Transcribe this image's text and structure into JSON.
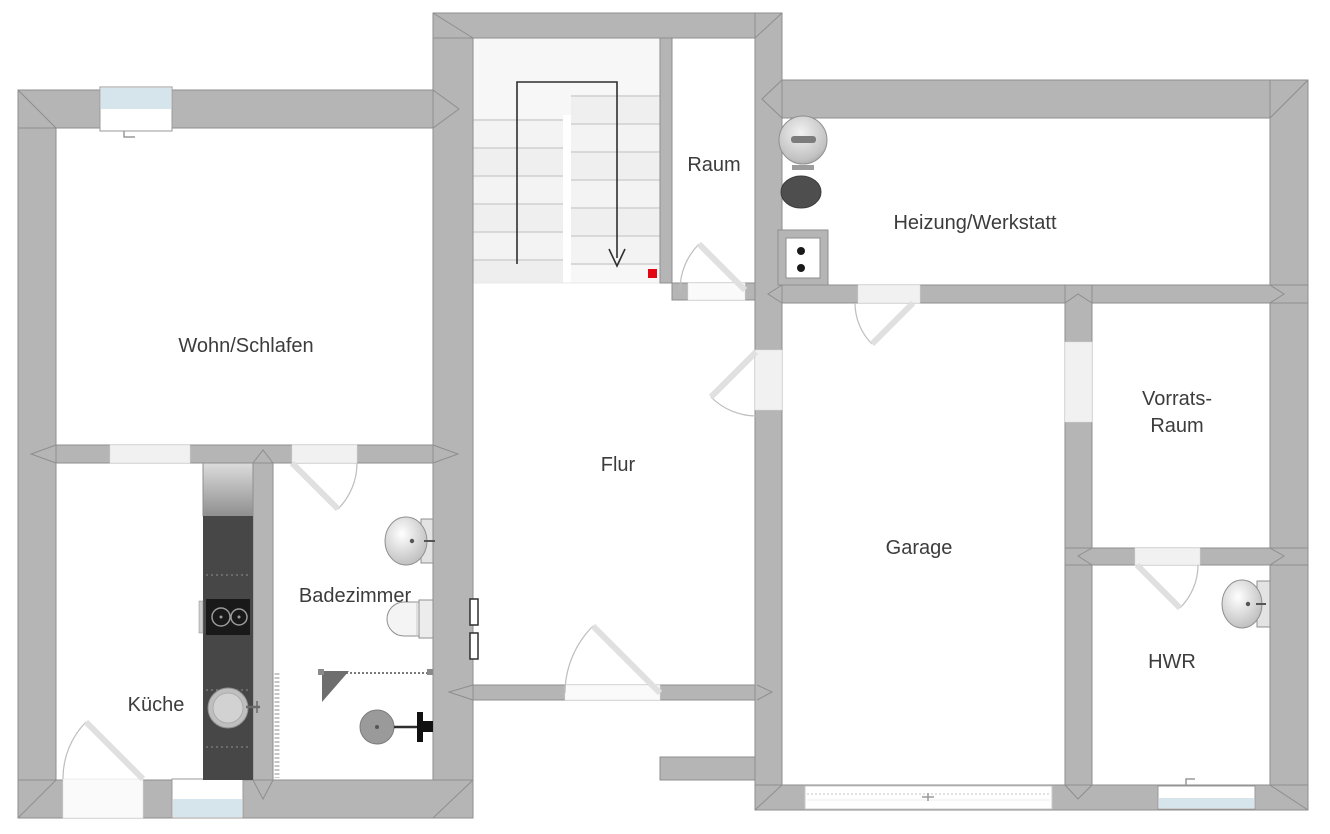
{
  "plan": {
    "type": "floor-plan",
    "floor": "basement-level",
    "rooms": {
      "wohn_schlafen": {
        "label": "Wohn/Schlafen"
      },
      "kueche": {
        "label": "Küche"
      },
      "badezimmer": {
        "label": "Badezimmer"
      },
      "flur": {
        "label": "Flur"
      },
      "raum": {
        "label": "Raum"
      },
      "heizung_werkstatt": {
        "label": "Heizung/Werkstatt"
      },
      "garage": {
        "label": "Garage"
      },
      "vorratsraum": {
        "label_line_1": "Vorrats-",
        "label_line_2": "Raum"
      },
      "hwr": {
        "label": "HWR"
      }
    },
    "colors": {
      "wall": "#b5b5b5",
      "wall_outline": "#8e8e8e",
      "window_glass": "#d6e4ec",
      "room_fill": "#ffffff",
      "doorway_fill": "#f1f1f1",
      "label_text": "#3c3c3c",
      "kitchen_counter": "#474747",
      "stair_arrow": "#2f2f2f",
      "position_marker_red": "#e30613"
    },
    "fixtures": {
      "staircase": "u-shaped-staircase-with-down-arrow",
      "boiler": "round-boiler-tank",
      "fuel_tank": "dark-fuel-tank",
      "chimney": "chimney-flue-two-vents",
      "refrigerator": "refrigerator",
      "kitchen_counter": "kitchen-counter-run",
      "cooktop": "cooktop-two-burners",
      "kitchen_sink": "round-kitchen-sink",
      "bathroom_sink": "washbasin",
      "toilet": "toilet",
      "shower": "corner-shower-with-drain-and-mixer",
      "hwr_sink": "washbasin",
      "garage_door": "wide-garage-door",
      "entry_door": "entry-door",
      "position_marker": "red-position-marker",
      "wall_panel": "wall-mounted-panel"
    }
  }
}
